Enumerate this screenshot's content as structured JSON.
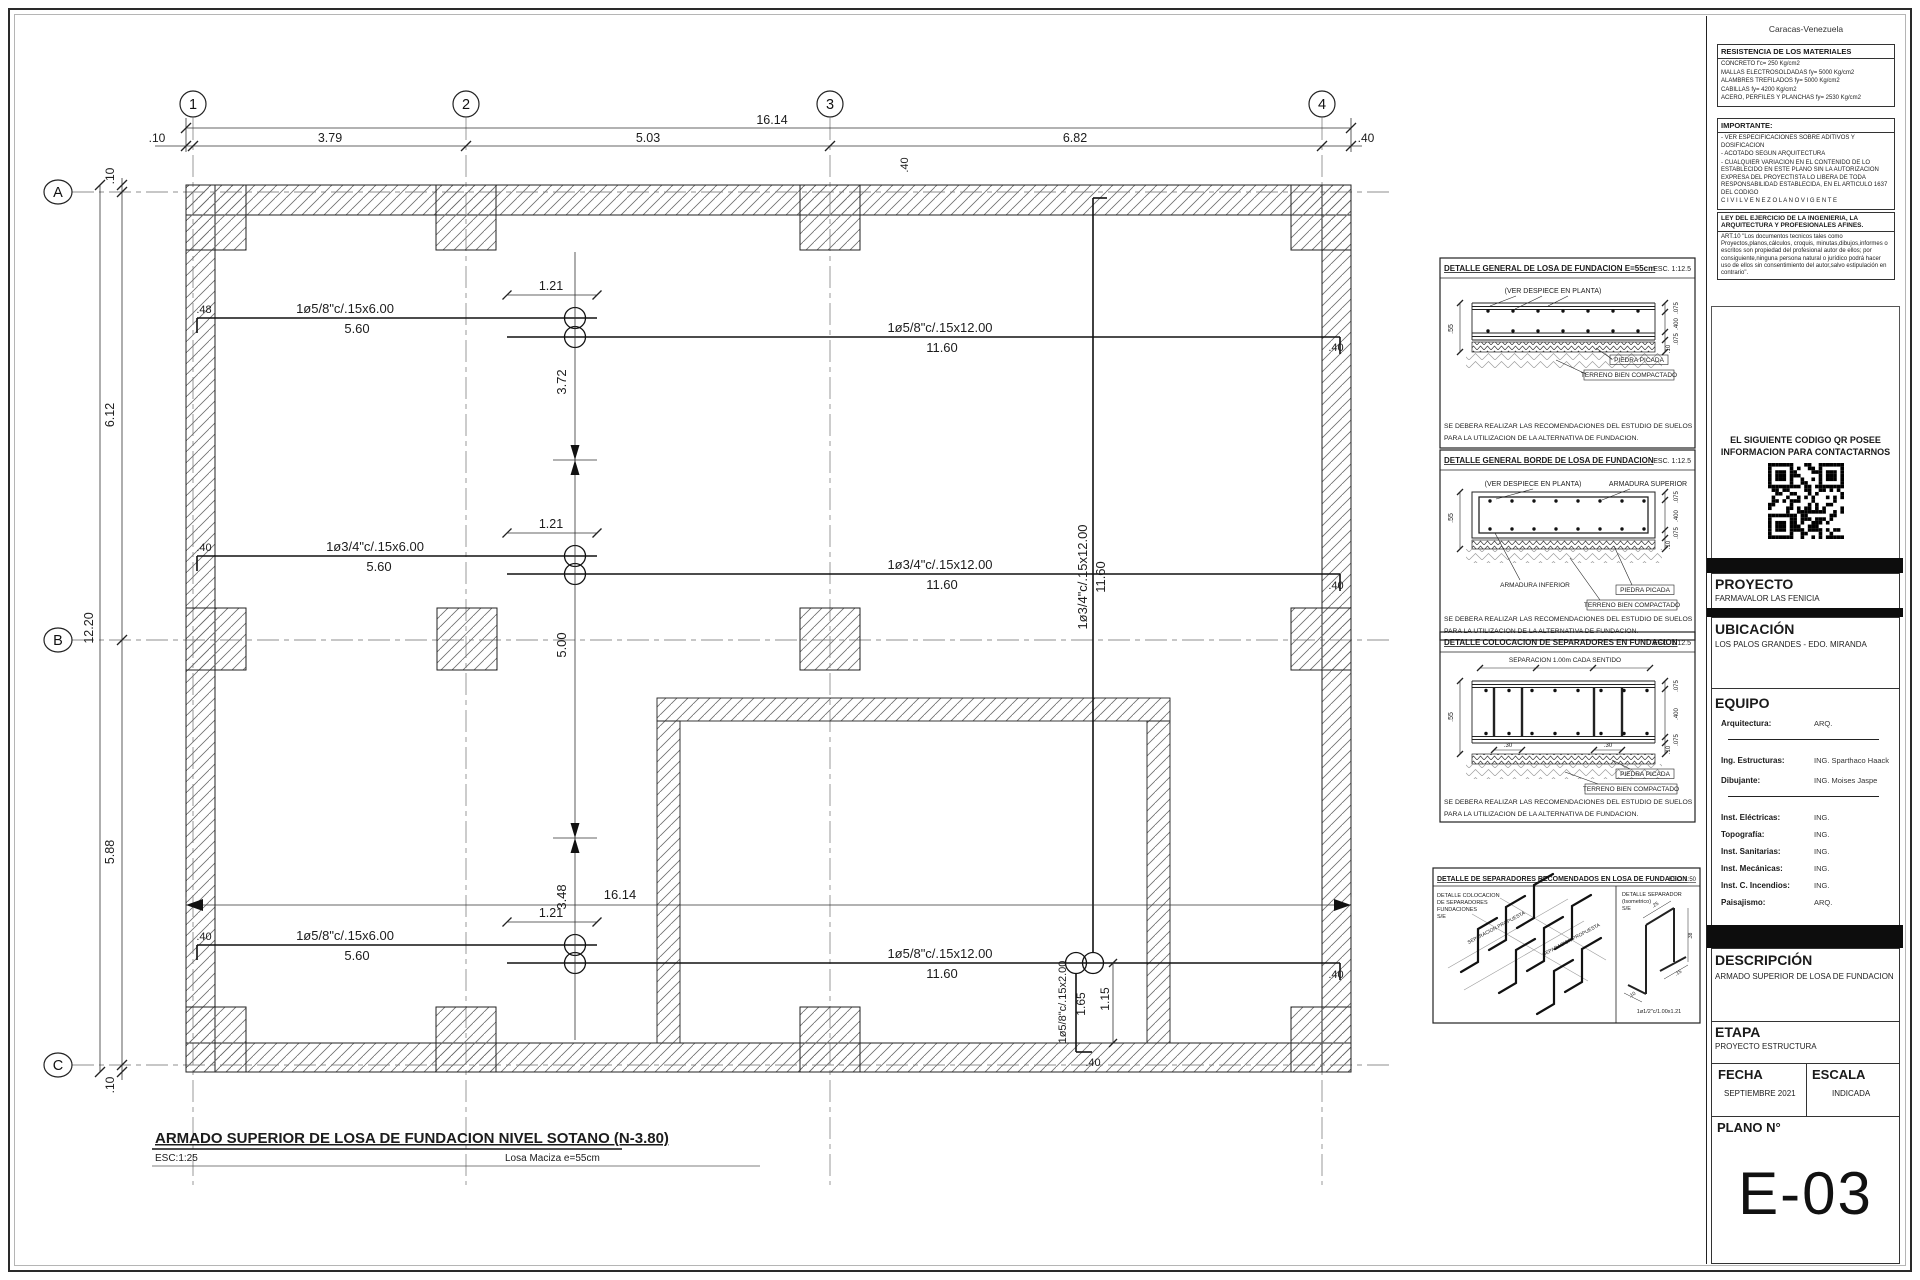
{
  "titleblock": {
    "city": "Caracas-Venezuela",
    "materials": {
      "header": "RESISTENCIA DE LOS MATERIALES",
      "lines": [
        "CONCRETO f'c= 250 Kg/cm2",
        "MALLAS ELECTROSOLDADAS fy= 5000 Kg/cm2",
        "ALAMBRES TREFILADOS fy= 5000 Kg/cm2",
        "CABILLAS fy= 4200 Kg/cm2",
        "ACERO, PERFILES Y PLANCHAS fy= 2530 Kg/cm2"
      ]
    },
    "importante": {
      "header": "IMPORTANTE:",
      "lines": [
        "- VER ESPECIFICACIONES SOBRE ADITIVOS Y DOSIFICACION",
        "- ACOTADO SEGUN ARQUITECTURA",
        "- CUALQUIER VARIACION EN EL CONTENIDO DE LO ESTABLECIDO EN ESTE PLANO SIN LA AUTORIZACION EXPRESA DEL PROYECTISTA LO LIBERA DE TODA RESPONSABILIDAD ESTABLECIDA, EN EL ARTICULO 1637 DEL CODIGO",
        "C I V I L   V E N E Z O L A N O   V I G E N T E"
      ]
    },
    "ley": {
      "header": "LEY DEL EJERCICIO DE LA INGENIERIA, LA ARQUITECTURA Y PROFESIONALES AFINES.",
      "body": "ART.10 \"Los documentos tecnicos tales como Proyectos,planos,cálculos, croquis, minutas,dibujos,informes o escritos son propiedad del profesional autor de ellos; por consiguiente,ninguna persona natural o jurídico podrá hacer uso de ellos sin consentimiento del autor,salvo estipulación en contrario\"."
    },
    "qr": {
      "line1": "EL SIGUIENTE CODIGO QR POSEE",
      "line2": "INFORMACION PARA CONTACTARNOS"
    },
    "proyecto": {
      "label": "PROYECTO",
      "value": "FARMAVALOR LAS FENICIA"
    },
    "ubicacion": {
      "label": "UBICACIÓN",
      "value": "LOS PALOS GRANDES - EDO. MIRANDA"
    },
    "equipo": {
      "label": "EQUIPO",
      "rows": [
        {
          "l": "Arquitectura:",
          "v": "ARQ."
        },
        {
          "l": "Ing. Estructuras:",
          "v": "ING. Sparthaco Haack"
        },
        {
          "l": "Dibujante:",
          "v": "ING. Moises Jaspe"
        },
        {
          "l": "Inst. Eléctricas:",
          "v": "ING."
        },
        {
          "l": "Topografía:",
          "v": "ING."
        },
        {
          "l": "Inst. Sanitarias:",
          "v": "ING."
        },
        {
          "l": "Inst. Mecánicas:",
          "v": "ING."
        },
        {
          "l": "Inst. C. Incendios:",
          "v": "ING."
        },
        {
          "l": "Paisajismo:",
          "v": "ARQ."
        }
      ]
    },
    "descripcion": {
      "label": "DESCRIPCIÓN",
      "value": "ARMADO SUPERIOR DE LOSA DE FUNDACION"
    },
    "etapa": {
      "label": "ETAPA",
      "value": "PROYECTO ESTRUCTURA"
    },
    "fecha": {
      "label": "FECHA",
      "value": "SEPTIEMBRE  2021"
    },
    "escala": {
      "label": "ESCALA",
      "value": "INDICADA"
    },
    "plano": {
      "label": "PLANO N°",
      "value": "E-03"
    }
  },
  "plan": {
    "grid": {
      "cols": [
        {
          "t": "1",
          "x": 193
        },
        {
          "t": "2",
          "x": 466
        },
        {
          "t": "3",
          "x": 830
        },
        {
          "t": "4",
          "x": 1322
        }
      ],
      "rows": [
        {
          "t": "A",
          "y": 192
        },
        {
          "t": "B",
          "y": 640
        },
        {
          "t": "C",
          "y": 1065
        }
      ]
    }
  },
  "svg_labels": [
    {
      "t": "ARMADO SUPERIOR DE LOSA DE FUNDACION NIVEL SOTANO (N-3.80)",
      "x": 155,
      "y": 1143,
      "fs": 15,
      "a": "s",
      "w": 1,
      "u": 1,
      "n": "plan-title"
    },
    {
      "t": "ESC:1:25",
      "x": 155,
      "y": 1161,
      "fs": 10,
      "a": "s",
      "n": "plan-scale"
    },
    {
      "t": "Losa  Maciza  e=55cm",
      "x": 505,
      "y": 1161,
      "fs": 10,
      "a": "s",
      "n": "plan-slab-note"
    },
    {
      "t": "16.14",
      "x": 772,
      "y": 124,
      "fs": 12.5
    },
    {
      "t": ".10",
      "x": 157,
      "y": 142,
      "fs": 12
    },
    {
      "t": "3.79",
      "x": 330,
      "y": 142,
      "fs": 12.5
    },
    {
      "t": "5.03",
      "x": 648,
      "y": 142,
      "fs": 12.5
    },
    {
      "t": "6.82",
      "x": 1075,
      "y": 142,
      "fs": 12.5
    },
    {
      "t": ".40",
      "x": 1366,
      "y": 142,
      "fs": 12
    },
    {
      "t": "12.20",
      "x": 93,
      "y": 628,
      "r": -90,
      "fs": 12.5
    },
    {
      "t": ".10",
      "x": 114,
      "y": 176,
      "r": -90,
      "fs": 12
    },
    {
      "t": "6.12",
      "x": 114,
      "y": 415,
      "r": -90,
      "fs": 12.5
    },
    {
      "t": "5.88",
      "x": 114,
      "y": 852,
      "r": -90,
      "fs": 12.5
    },
    {
      "t": ".10",
      "x": 114,
      "y": 1085,
      "r": -90,
      "fs": 12
    },
    {
      "t": "1ø5/8\"c/.15x6.00",
      "x": 345,
      "y": 313,
      "fs": 13,
      "n": "rebar-callout"
    },
    {
      "t": "5.60",
      "x": 357,
      "y": 333,
      "fs": 13,
      "n": "rebar-callout"
    },
    {
      "t": "1.21",
      "x": 551,
      "y": 290,
      "fs": 12.5
    },
    {
      "t": "1ø5/8\"c/.15x12.00",
      "x": 940,
      "y": 332,
      "fs": 13,
      "n": "rebar-callout"
    },
    {
      "t": "11.60",
      "x": 942,
      "y": 352,
      "fs": 13,
      "n": "rebar-callout"
    },
    {
      "t": "3.72",
      "x": 566,
      "y": 382,
      "r": -90,
      "fs": 13
    },
    {
      "t": ".48",
      "x": 204,
      "y": 313,
      "fs": 11
    },
    {
      "t": ".40",
      "x": 1336,
      "y": 351,
      "fs": 11
    },
    {
      "t": ".40",
      "x": 908,
      "y": 165,
      "r": -90,
      "fs": 11
    },
    {
      "t": "1ø3/4\"c/.15x6.00",
      "x": 375,
      "y": 551,
      "fs": 13,
      "n": "rebar-callout"
    },
    {
      "t": "5.60",
      "x": 379,
      "y": 571,
      "fs": 13,
      "n": "rebar-callout"
    },
    {
      "t": "1.21",
      "x": 551,
      "y": 528,
      "fs": 12.5
    },
    {
      "t": "1ø3/4\"c/.15x12.00",
      "x": 940,
      "y": 569,
      "fs": 13,
      "n": "rebar-callout"
    },
    {
      "t": "11.60",
      "x": 942,
      "y": 589,
      "fs": 13,
      "n": "rebar-callout"
    },
    {
      "t": ".40",
      "x": 204,
      "y": 551,
      "fs": 11
    },
    {
      "t": ".40",
      "x": 1336,
      "y": 589,
      "fs": 11
    },
    {
      "t": "5.00",
      "x": 566,
      "y": 645,
      "r": -90,
      "fs": 13
    },
    {
      "t": "1ø3/4\"c/.15x12.00",
      "x": 1087,
      "y": 577,
      "r": -90,
      "fs": 13,
      "n": "rebar-callout"
    },
    {
      "t": "11.60",
      "x": 1105,
      "y": 577,
      "r": -90,
      "fs": 13,
      "n": "rebar-callout"
    },
    {
      "t": "1ø5/8\"c/.15x6.00",
      "x": 345,
      "y": 940,
      "fs": 13,
      "n": "rebar-callout"
    },
    {
      "t": "5.60",
      "x": 357,
      "y": 960,
      "fs": 13,
      "n": "rebar-callout"
    },
    {
      "t": "1.21",
      "x": 551,
      "y": 917,
      "fs": 12.5
    },
    {
      "t": "3.48",
      "x": 566,
      "y": 897,
      "r": -90,
      "fs": 13
    },
    {
      "t": "1ø5/8\"c/.15x12.00",
      "x": 940,
      "y": 958,
      "fs": 13,
      "n": "rebar-callout"
    },
    {
      "t": "11.60",
      "x": 942,
      "y": 978,
      "fs": 13,
      "n": "rebar-callout"
    },
    {
      "t": "16.14",
      "x": 620,
      "y": 899,
      "fs": 13
    },
    {
      "t": ".40",
      "x": 204,
      "y": 940,
      "fs": 11
    },
    {
      "t": ".40",
      "x": 1336,
      "y": 978,
      "fs": 11
    },
    {
      "t": "1ø5/8\"c/.15x2.00",
      "x": 1066,
      "y": 1002,
      "r": -90,
      "fs": 11,
      "n": "rebar-callout"
    },
    {
      "t": "1.65",
      "x": 1085,
      "y": 1004,
      "r": -90,
      "fs": 12
    },
    {
      "t": "1.15",
      "x": 1109,
      "y": 999,
      "r": -90,
      "fs": 12
    },
    {
      "t": ".40",
      "x": 1093,
      "y": 1066,
      "fs": 11
    },
    {
      "t": "DETALLE GENERAL DE LOSA DE FUNDACION E=55cm",
      "x": 1444,
      "y": 271,
      "fs": 8,
      "a": "s",
      "w": 1,
      "u": 1,
      "n": "detail-title"
    },
    {
      "t": "ESC. 1:12.5",
      "x": 1691,
      "y": 271,
      "fs": 7,
      "a": "e",
      "n": "detail-scale"
    },
    {
      "t": "(VER DESPIECE EN PLANTA)",
      "x": 1553,
      "y": 293,
      "fs": 7,
      "n": "detail-label"
    },
    {
      "t": ".55",
      "x": 1453,
      "y": 329,
      "fs": 7,
      "r": -90
    },
    {
      "t": ".075",
      "x": 1678,
      "y": 308,
      "fs": 6,
      "r": -90
    },
    {
      "t": ".400",
      "x": 1678,
      "y": 324,
      "fs": 6,
      "r": -90
    },
    {
      "t": ".075",
      "x": 1678,
      "y": 339,
      "fs": 6,
      "r": -90
    },
    {
      "t": ".10",
      "x": 1670,
      "y": 349,
      "fs": 6,
      "r": -90
    },
    {
      "t": "PIEDRA PICADA",
      "x": 1639,
      "y": 362,
      "fs": 6.5,
      "n": "detail-label"
    },
    {
      "t": "TERRENO BIEN COMPACTADO",
      "x": 1629,
      "y": 377,
      "fs": 6.5,
      "n": "detail-label"
    },
    {
      "t": "SE DEBERA REALIZAR LAS RECOMENDACIONES DEL ESTUDIO DE SUELOS",
      "x": 1444,
      "y": 428,
      "fs": 6.8,
      "a": "s",
      "n": "detail-note"
    },
    {
      "t": "PARA LA UTILIZACION DE LA ALTERNATIVA DE FUNDACION.",
      "x": 1444,
      "y": 440,
      "fs": 6.8,
      "a": "s",
      "n": "detail-note"
    },
    {
      "t": "DETALLE GENERAL BORDE DE LOSA DE FUNDACION",
      "x": 1444,
      "y": 463,
      "fs": 8,
      "a": "s",
      "w": 1,
      "u": 1,
      "n": "detail-title"
    },
    {
      "t": "ESC. 1:12.5",
      "x": 1691,
      "y": 463,
      "fs": 7,
      "a": "e",
      "n": "detail-scale"
    },
    {
      "t": "(VER DESPIECE EN PLANTA)",
      "x": 1533,
      "y": 486,
      "fs": 7,
      "n": "detail-label"
    },
    {
      "t": "ARMADURA SUPERIOR",
      "x": 1648,
      "y": 486,
      "fs": 7,
      "n": "detail-label"
    },
    {
      "t": ".55",
      "x": 1453,
      "y": 518,
      "fs": 7,
      "r": -90
    },
    {
      "t": ".075",
      "x": 1678,
      "y": 497,
      "fs": 6,
      "r": -90
    },
    {
      "t": ".400",
      "x": 1678,
      "y": 516,
      "fs": 6,
      "r": -90
    },
    {
      "t": ".075",
      "x": 1678,
      "y": 533,
      "fs": 6,
      "r": -90
    },
    {
      "t": ".10",
      "x": 1670,
      "y": 545,
      "fs": 6,
      "r": -90
    },
    {
      "t": "ARMADURA INFERIOR",
      "x": 1535,
      "y": 587,
      "fs": 6.5,
      "n": "detail-label"
    },
    {
      "t": "PIEDRA PICADA",
      "x": 1645,
      "y": 592,
      "fs": 6.5,
      "n": "detail-label"
    },
    {
      "t": "TERRENO BIEN COMPACTADO",
      "x": 1632,
      "y": 607,
      "fs": 6.5,
      "n": "detail-label"
    },
    {
      "t": "SE DEBERA REALIZAR LAS RECOMENDACIONES DEL ESTUDIO DE SUELOS",
      "x": 1444,
      "y": 621,
      "fs": 6.8,
      "a": "s",
      "n": "detail-note"
    },
    {
      "t": "PARA LA UTILIZACION DE LA ALTERNATIVA DE FUNDACION.",
      "x": 1444,
      "y": 633,
      "fs": 6.8,
      "a": "s",
      "n": "detail-note"
    },
    {
      "t": "DETALLE COLOCACION DE SEPARADORES EN FUNDACION",
      "x": 1444,
      "y": 645,
      "fs": 8,
      "a": "s",
      "w": 1,
      "u": 1,
      "n": "detail-title"
    },
    {
      "t": "ESC. 1:12.5",
      "x": 1691,
      "y": 645,
      "fs": 7,
      "a": "e",
      "n": "detail-scale"
    },
    {
      "t": "SEPARACION  1.00m  CADA  SENTIDO",
      "x": 1565,
      "y": 662,
      "fs": 6.5,
      "n": "detail-label"
    },
    {
      "t": ".55",
      "x": 1453,
      "y": 717,
      "fs": 7,
      "r": -90
    },
    {
      "t": ".30",
      "x": 1508,
      "y": 747,
      "fs": 6
    },
    {
      "t": ".30",
      "x": 1608,
      "y": 747,
      "fs": 6
    },
    {
      "t": ".075",
      "x": 1678,
      "y": 686,
      "fs": 6,
      "r": -90
    },
    {
      "t": ".400",
      "x": 1678,
      "y": 714,
      "fs": 6,
      "r": -90
    },
    {
      "t": ".075",
      "x": 1678,
      "y": 740,
      "fs": 6,
      "r": -90
    },
    {
      "t": ".10",
      "x": 1670,
      "y": 750,
      "fs": 6,
      "r": -90
    },
    {
      "t": "PIEDRA PICADA",
      "x": 1645,
      "y": 776,
      "fs": 6.5,
      "n": "detail-label"
    },
    {
      "t": "TERRENO BIEN COMPACTADO",
      "x": 1631,
      "y": 791,
      "fs": 6.5,
      "n": "detail-label"
    },
    {
      "t": "SE DEBERA REALIZAR LAS RECOMENDACIONES DEL ESTUDIO DE SUELOS",
      "x": 1444,
      "y": 804,
      "fs": 6.8,
      "a": "s",
      "n": "detail-note"
    },
    {
      "t": "PARA LA UTILIZACION DE LA ALTERNATIVA DE FUNDACION.",
      "x": 1444,
      "y": 816,
      "fs": 6.8,
      "a": "s",
      "n": "detail-note"
    },
    {
      "t": "DETALLE DE SEPARADORES RECOMENDADOS EN LOSA DE FUNDACION",
      "x": 1437,
      "y": 881,
      "fs": 7,
      "a": "s",
      "w": 1,
      "u": 1,
      "n": "detail-title"
    },
    {
      "t": "ESC. 1:50",
      "x": 1696,
      "y": 881,
      "fs": 6,
      "a": "e",
      "u": 1,
      "n": "detail-scale"
    },
    {
      "t": "DETALLE COLOCACION",
      "x": 1437,
      "y": 897,
      "fs": 5.5,
      "a": "s",
      "n": "detail-label"
    },
    {
      "t": "DE SEPARADORES",
      "x": 1437,
      "y": 904,
      "fs": 5.5,
      "a": "s",
      "n": "detail-label"
    },
    {
      "t": "FUNDACIONES",
      "x": 1437,
      "y": 911,
      "fs": 5.5,
      "a": "s",
      "n": "detail-label"
    },
    {
      "t": "S/E",
      "x": 1437,
      "y": 918,
      "fs": 5.5,
      "a": "s",
      "n": "detail-label"
    },
    {
      "t": "SEPARACION PROPUESTA",
      "x": 1497,
      "y": 929,
      "fs": 5,
      "r": -28,
      "n": "detail-label"
    },
    {
      "t": "SEPARACION PROPUESTA",
      "x": 1572,
      "y": 941,
      "fs": 5,
      "r": -28,
      "n": "detail-label"
    },
    {
      "t": "DETALLE SEPARADOR",
      "x": 1622,
      "y": 896,
      "fs": 5.5,
      "a": "s",
      "n": "detail-label"
    },
    {
      "t": "(Isometrico)",
      "x": 1622,
      "y": 903,
      "fs": 5.5,
      "a": "s",
      "n": "detail-label"
    },
    {
      "t": "S/E",
      "x": 1622,
      "y": 910,
      "fs": 5.5,
      "a": "s",
      "n": "detail-label"
    },
    {
      "t": ".25",
      "x": 1656,
      "y": 906,
      "fs": 5,
      "r": -32
    },
    {
      "t": ".38",
      "x": 1692,
      "y": 936,
      "fs": 5,
      "r": -90
    },
    {
      "t": ".15",
      "x": 1679,
      "y": 974,
      "fs": 5,
      "r": -32
    },
    {
      "t": ".10",
      "x": 1633,
      "y": 996,
      "fs": 5,
      "r": -32
    },
    {
      "t": "1ø1/2\"c/1.00x1.21",
      "x": 1659,
      "y": 1013,
      "fs": 5.5,
      "n": "detail-label"
    }
  ]
}
